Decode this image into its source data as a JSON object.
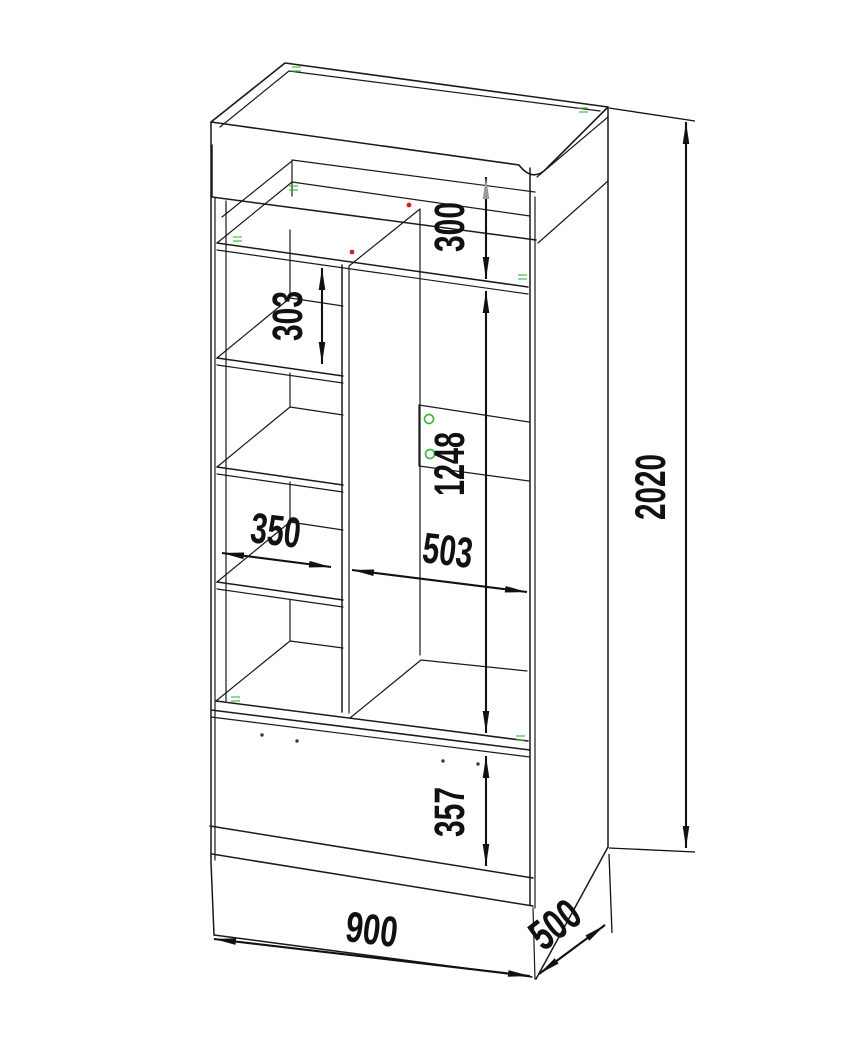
{
  "drawing": {
    "kind": "furniture-cabinet-dimension-diagram",
    "units": "mm"
  },
  "dims": {
    "niche_height": "300",
    "shelf_spacing": "303",
    "right_section_height": "1248",
    "left_section_width": "350",
    "right_section_width": "503",
    "overall_height": "2020",
    "drawer_front_height": "357",
    "overall_width": "900",
    "overall_depth": "500"
  },
  "colors": {
    "line": "#1a1a1a",
    "dim_text": "#111111",
    "gray_arrow": "#9a9a9a",
    "accent_green": "#3cb83c",
    "accent_red": "#cc2222",
    "background": "#ffffff"
  }
}
